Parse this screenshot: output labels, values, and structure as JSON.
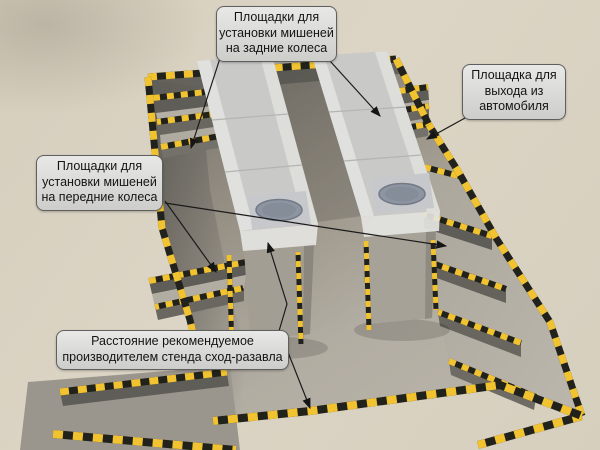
{
  "diagram": {
    "callouts": {
      "rear_targets": {
        "text": "Площадки для\nустановки мишеней\nна задние колеса"
      },
      "exit_platform": {
        "text": "Площадка для\nвыхода из\nавтомобиля"
      },
      "front_targets": {
        "text": "Площадки для\nустановки мишеней\nна передние колеса"
      },
      "distance": {
        "text": "Расстояние рекомендуемое\nпроизводителем стенда сход-разавла"
      }
    },
    "colors": {
      "ground": "#d8d1c1",
      "hazard_yellow": "#f1c330",
      "hazard_black": "#22221d",
      "pit_floor": "#b0aba0",
      "pit_wall_dark": "#6b6963",
      "runway": "#d0d0ce",
      "turnplate": "#8d95a2",
      "callout_bg": "#d9d9d9",
      "callout_border": "#5f5f5f",
      "arrow": "#1b1b1b"
    }
  }
}
